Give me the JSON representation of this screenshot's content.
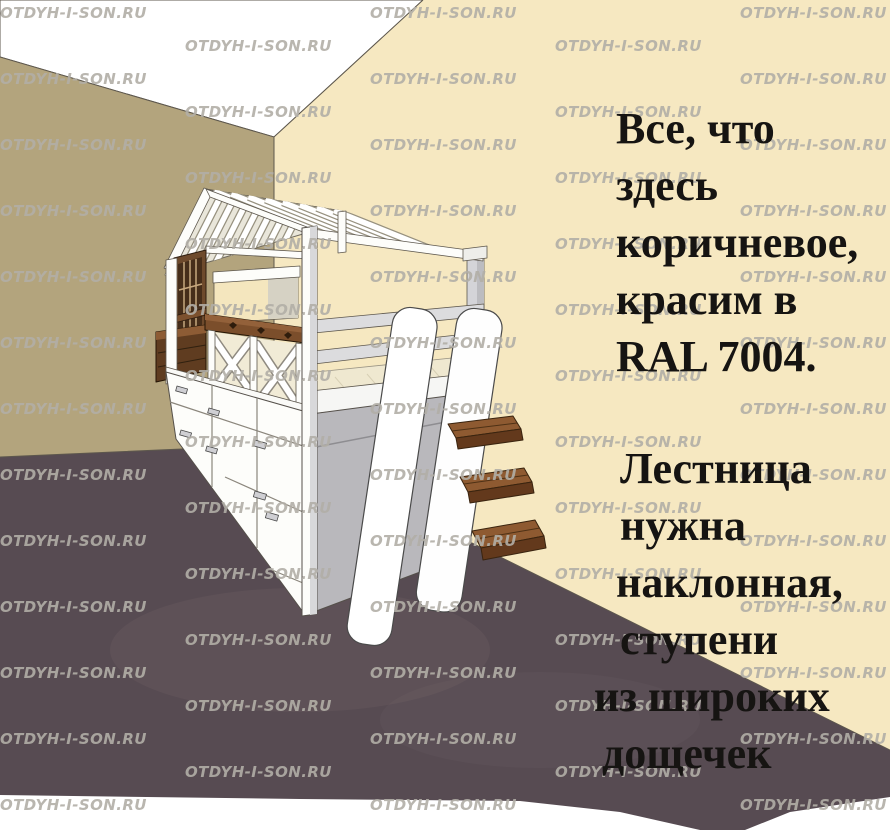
{
  "watermark": {
    "text": "OTDYH-I-SON.RU"
  },
  "notes": {
    "paint": {
      "lines": [
        "Все, что",
        "здесь",
        "коричневое,",
        "красим в",
        "RAL 7004."
      ]
    },
    "ladder": {
      "lines": [
        "Лестница",
        "нужна",
        "наклонная,",
        "ступени",
        "из широких",
        "дощечек"
      ]
    }
  },
  "colors": {
    "ceiling": "#ffffff",
    "wall_left": "#b3a47d",
    "wall_right": "#f6e8c1",
    "floor": "#574b52",
    "bed_white": "#fdfdfa",
    "wood_brown": "#7b4e2b",
    "mattress": "#efe8d0",
    "note_text": "#161412",
    "watermark": "#b2aea6"
  }
}
